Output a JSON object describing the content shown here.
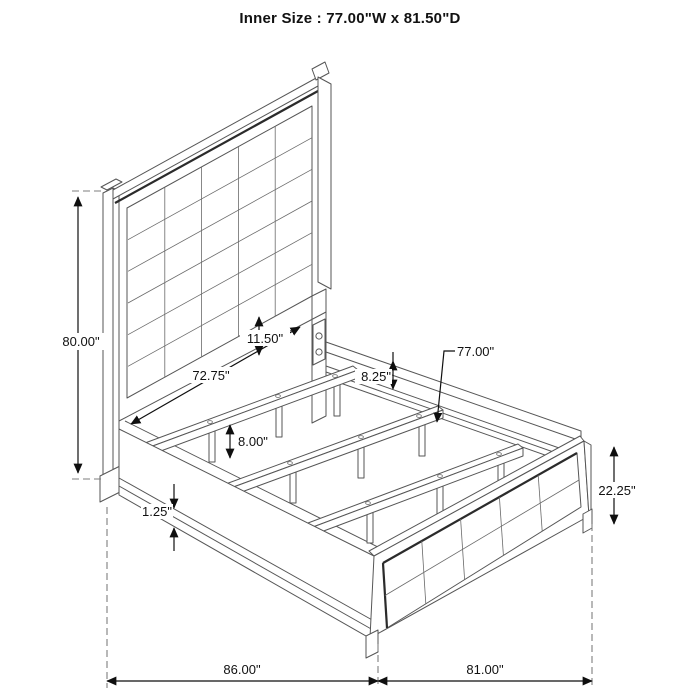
{
  "title": "Inner Size : 77.00\"W x 81.50\"D",
  "diagram": "bed-frame-dimension-drawing",
  "dimensions": {
    "headboard_height": "80.00\"",
    "headboard_panel_width": "72.75\"",
    "side_rail_height": "11.50\"",
    "rail_to_slat_drop": "8.25\"",
    "slat_length": "77.00\"",
    "slat_leg_height": "8.00\"",
    "base_trim_thickness": "1.25\"",
    "footboard_height": "22.25\"",
    "overall_depth": "86.00\"",
    "overall_width": "81.00\""
  },
  "colors": {
    "background": "#ffffff",
    "structure_line": "#565656",
    "accent_line": "#2b2b2b",
    "dimension_line": "#0f0f0f",
    "extension_dash": "#7d7d7d",
    "text": "#111111"
  }
}
